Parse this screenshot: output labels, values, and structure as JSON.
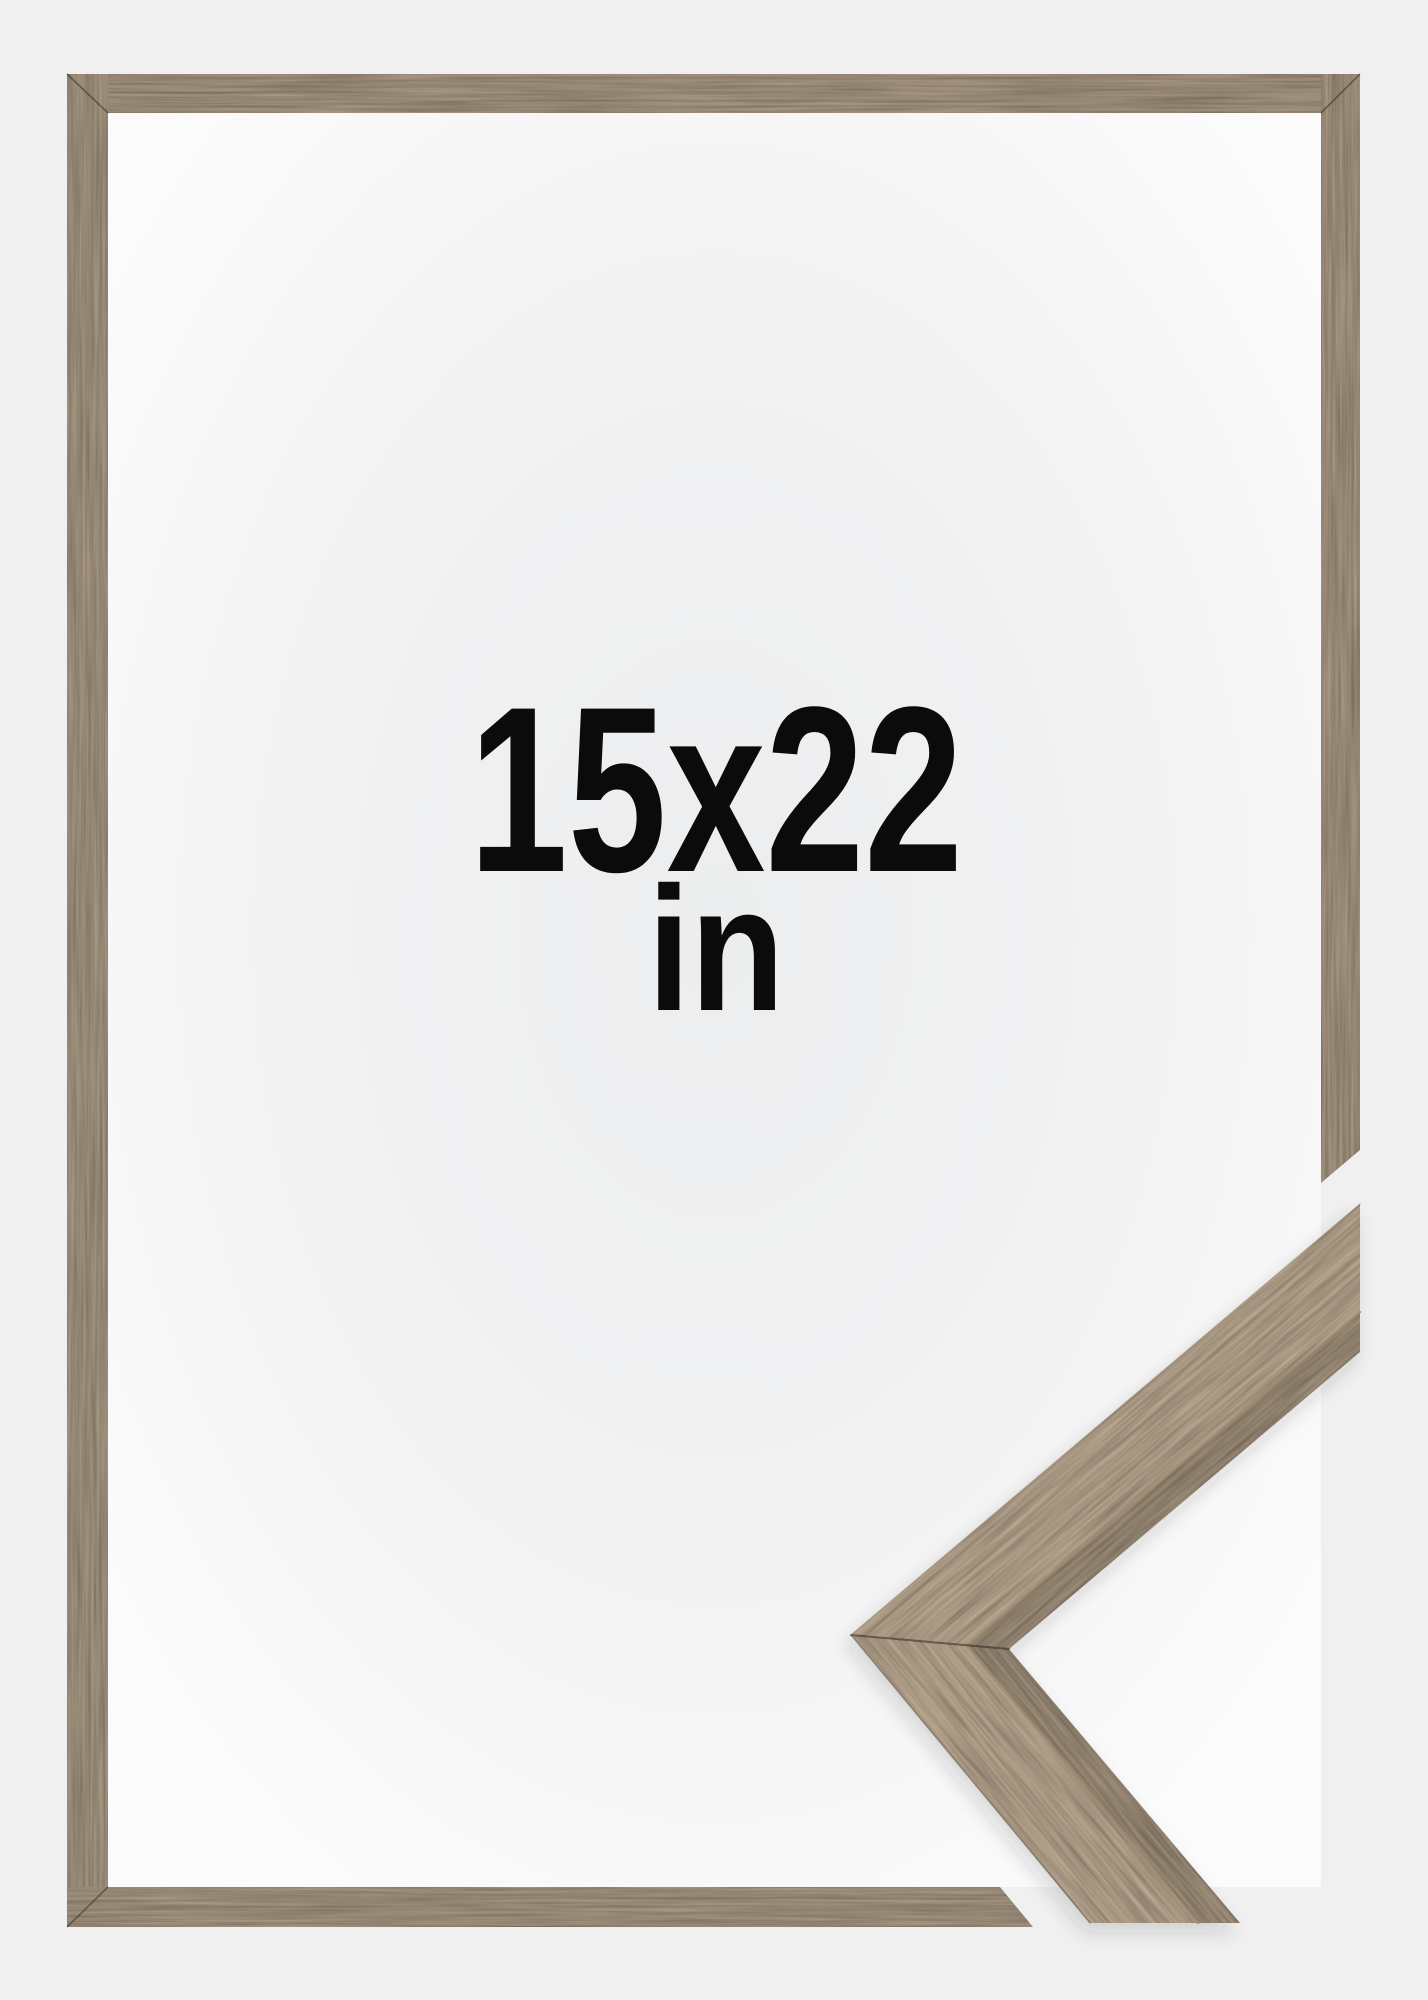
{
  "product_image": {
    "description": "picture frame product photo with corner close-up sample",
    "size_label": "15x22",
    "unit_label": "in",
    "frame_material": "dark walnut wood",
    "colors": {
      "background": "#f0f0f1",
      "interior_center": "#ecedee",
      "interior_edge": "#fbfbfc",
      "wood_bar_mid": "#4d3d2d",
      "wood_face_mid": "#614e38",
      "wood_side_mid": "#453626",
      "seam_highlight": "#a08c6d",
      "text": "#0b0b0b"
    }
  }
}
